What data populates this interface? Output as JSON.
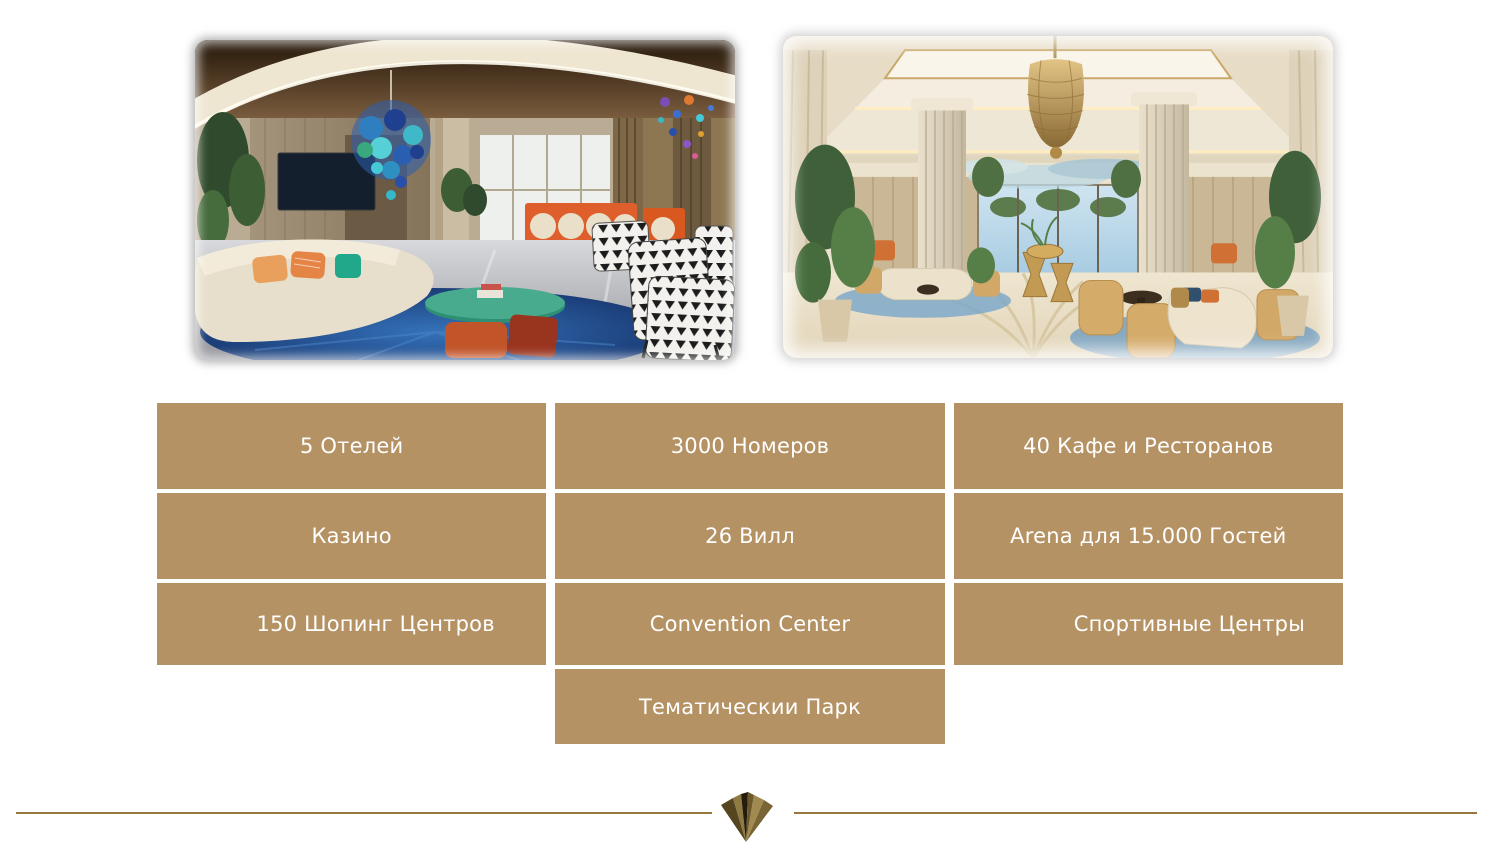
{
  "theme": {
    "tan": "#b59264",
    "gold-line": "#97783c",
    "text-on-tan": "#ffffff"
  },
  "images": [
    {
      "name": "lounge-photo",
      "alt": "Hotel lounge interior: blue glass chandelier, cream curved sofa with orange pillows, green glass coffee table, blue rug, black-and-white triangle patterned armchairs"
    },
    {
      "name": "grand-lobby-photo",
      "alt": "Grand hotel lobby: fluted marble columns, gold mesh chandelier, coffered ceiling, palm-motif marble floor, tan and cream seating"
    }
  ],
  "stats": {
    "cells": [
      {
        "id": "hotels",
        "label": "5 Отелей"
      },
      {
        "id": "rooms",
        "label": "3000 Номеров"
      },
      {
        "id": "cafes",
        "label": "40 Кафе и Ресторанов"
      },
      {
        "id": "casino",
        "label": "Казино"
      },
      {
        "id": "villas",
        "label": "26 Вилл"
      },
      {
        "id": "arena",
        "label": "Arena для 15.000 Гостей"
      },
      {
        "id": "shopping",
        "label": "150 Шопинг Центров"
      },
      {
        "id": "convention",
        "label": "Convention Center"
      },
      {
        "id": "sports",
        "label": "Спортивные Центры"
      },
      {
        "id": "themepark",
        "label": "Тематическии Парк"
      }
    ]
  },
  "footer": {
    "emblem": "faceted-gold-emblem"
  }
}
